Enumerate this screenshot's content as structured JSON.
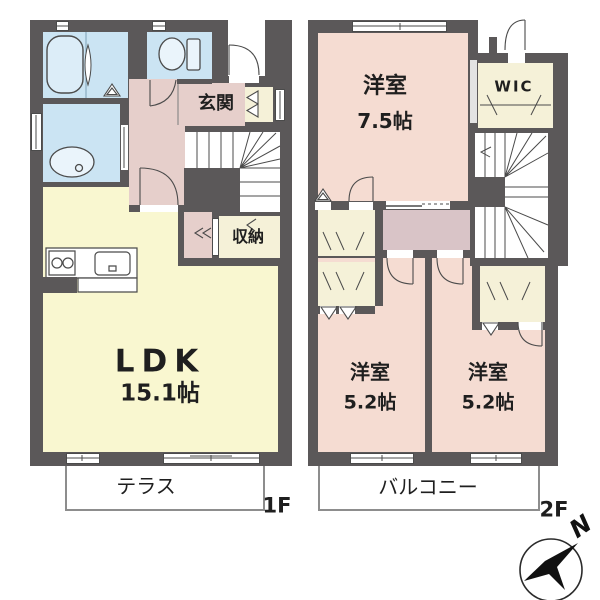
{
  "plan": {
    "floor1": {
      "label": "1F",
      "ldk_name": "LDK",
      "ldk_size": "15.1帖",
      "genkan": "玄関",
      "storage": "収納",
      "terrace": "テラス"
    },
    "floor2": {
      "label": "2F",
      "main_room_name": "洋室",
      "main_room_size": "7.5帖",
      "wic": "WIC",
      "room2_name": "洋室",
      "room2_size": "5.2帖",
      "room3_name": "洋室",
      "room3_size": "5.2帖",
      "balcony": "バルコニー"
    },
    "compass_north": "N",
    "colors": {
      "wall": "#5b5859",
      "wet_blue": "#cbe4f3",
      "room_pink": "#f5dcd2",
      "hall_pink_1f": "#e6cfcb",
      "hall_pink_2f": "#d9c4c7",
      "ldk_yellow": "#f9f7d0",
      "closet_cream": "#f5f1d8"
    }
  }
}
